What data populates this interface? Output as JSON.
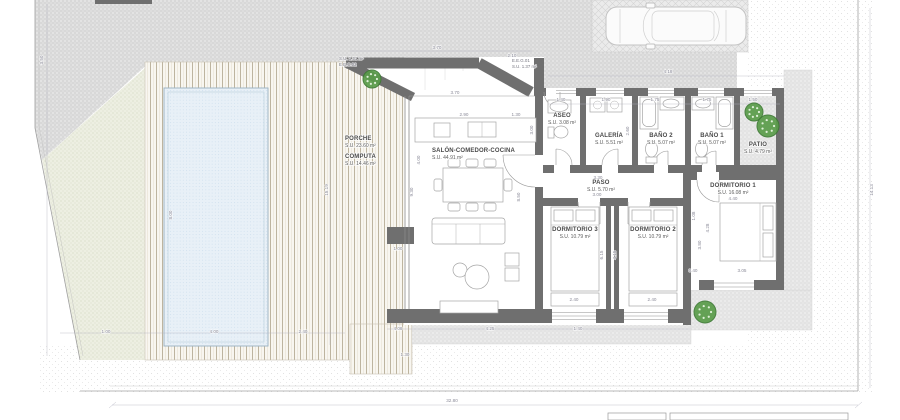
{
  "drawing": {
    "type": "architectural-floor-plan",
    "overall_width_label": "32.80"
  },
  "colors": {
    "walls": "#6f6f6f",
    "ground_hatch": "#d8d8d8",
    "lawn": "#edefe2",
    "deck_line": "#bdb49f",
    "pool_water": "#e8f0f7",
    "tree": "#5a9c4a",
    "dim_text": "#8a8a98",
    "label_text": "#4a4a4a"
  },
  "rooms": [
    {
      "id": "porche",
      "name": "PORCHE",
      "area": "S.U. 23.60 m²",
      "x": 345,
      "y": 140,
      "align": "start"
    },
    {
      "id": "computa",
      "name": "COMPUTA",
      "area": "S.U. 14.46 m²",
      "x": 345,
      "y": 158,
      "align": "start"
    },
    {
      "id": "salon",
      "name": "SALÓN-COMEDOR-COCINA",
      "area": "S.U. 44.91 m²",
      "x": 432,
      "y": 152,
      "align": "start"
    },
    {
      "id": "aseo",
      "name": "ASEO",
      "area": "S.U. 3.08 m²",
      "x": 562,
      "y": 117,
      "align": "middle"
    },
    {
      "id": "galeria",
      "name": "GALERÍA",
      "area": "S.U. 5.51 m²",
      "x": 609,
      "y": 137,
      "align": "middle"
    },
    {
      "id": "bano2",
      "name": "BAÑO 2",
      "area": "S.U. 5.07 m²",
      "x": 661,
      "y": 137,
      "align": "middle"
    },
    {
      "id": "bano1",
      "name": "BAÑO 1",
      "area": "S.U. 5.07 m²",
      "x": 712,
      "y": 137,
      "align": "middle"
    },
    {
      "id": "patio",
      "name": "PATIO",
      "area": "S.U. 4.79 m²",
      "x": 758,
      "y": 146,
      "align": "middle"
    },
    {
      "id": "paso",
      "name": "PASO",
      "area": "S.U. 5.70 m²",
      "x": 601,
      "y": 184,
      "align": "middle"
    },
    {
      "id": "dormitorio1",
      "name": "DORMITORIO 1",
      "area": "S.U. 16.08 m²",
      "x": 733,
      "y": 187,
      "align": "middle"
    },
    {
      "id": "dormitorio3",
      "name": "DORMITORIO 3",
      "area": "S.U. 10.79 m²",
      "x": 575,
      "y": 231,
      "align": "middle"
    },
    {
      "id": "dormitorio2",
      "name": "DORMITORIO 2",
      "area": "S.U. 10.79 m²",
      "x": 653,
      "y": 231,
      "align": "middle"
    }
  ],
  "annotations": {
    "a0": {
      "line1": "S.U. 1.31 m²",
      "line2": "E.E.C.02"
    },
    "a1": {
      "line1": "E.E.G.01",
      "line2": "S.U. 1.37 m²"
    }
  },
  "dimensions": [
    {
      "t": "3.70",
      "x": 437,
      "y": 49
    },
    {
      "t": "2.10",
      "x": 512,
      "y": 57
    },
    {
      "t": "4.18",
      "x": 668,
      "y": 73
    },
    {
      "t": "3.70",
      "x": 455,
      "y": 94
    },
    {
      "t": "2.90",
      "x": 464,
      "y": 116
    },
    {
      "t": "1.30",
      "x": 516,
      "y": 116
    },
    {
      "t": "1.40",
      "x": 561,
      "y": 101
    },
    {
      "t": "1.90",
      "x": 606,
      "y": 101
    },
    {
      "t": "1.75",
      "x": 655,
      "y": 101
    },
    {
      "t": "1.75",
      "x": 707,
      "y": 101
    },
    {
      "t": "1.50",
      "x": 753,
      "y": 101
    },
    {
      "t": "3.00",
      "x": 533,
      "y": 130,
      "rot": -90
    },
    {
      "t": "2.60",
      "x": 629,
      "y": 131,
      "rot": -90
    },
    {
      "t": "3.30",
      "x": 598,
      "y": 179
    },
    {
      "t": "3.00",
      "x": 597,
      "y": 196
    },
    {
      "t": "4.40",
      "x": 733,
      "y": 200
    },
    {
      "t": "1.08",
      "x": 695,
      "y": 216,
      "rot": -90
    },
    {
      "t": "6.15",
      "x": 603,
      "y": 255,
      "rot": -90
    },
    {
      "t": "4.15",
      "x": 616,
      "y": 255,
      "rot": -90
    },
    {
      "t": "4.28",
      "x": 709,
      "y": 228,
      "rot": -90
    },
    {
      "t": "3.80",
      "x": 701,
      "y": 245,
      "rot": -90
    },
    {
      "t": "2.40",
      "x": 574,
      "y": 301
    },
    {
      "t": "2.40",
      "x": 652,
      "y": 301
    },
    {
      "t": "0.40",
      "x": 693,
      "y": 272
    },
    {
      "t": "3.05",
      "x": 742,
      "y": 272
    },
    {
      "t": "9.30",
      "x": 413,
      "y": 192,
      "rot": -90
    },
    {
      "t": "4.00",
      "x": 420,
      "y": 160,
      "rot": -90
    },
    {
      "t": "8.50",
      "x": 520,
      "y": 197,
      "rot": -90
    },
    {
      "t": "1.00",
      "x": 398,
      "y": 250
    },
    {
      "t": "1.00",
      "x": 106,
      "y": 333
    },
    {
      "t": "4.00",
      "x": 214,
      "y": 333
    },
    {
      "t": "2.40",
      "x": 303,
      "y": 333
    },
    {
      "t": "8.00",
      "x": 172,
      "y": 215,
      "rot": -90
    },
    {
      "t": "15.19",
      "x": 328,
      "y": 190,
      "rot": -90
    },
    {
      "t": "4.08",
      "x": 398,
      "y": 330
    },
    {
      "t": "4.25",
      "x": 490,
      "y": 330
    },
    {
      "t": "1.40",
      "x": 578,
      "y": 330
    },
    {
      "t": "1.30",
      "x": 405,
      "y": 356
    },
    {
      "t": "3.50",
      "x": 43,
      "y": 60,
      "rot": -90
    },
    {
      "t": "14.13",
      "x": 873,
      "y": 190,
      "rot": -90
    },
    {
      "t": "32.80",
      "x": 452,
      "y": 402
    }
  ],
  "site": {
    "trees": [
      {
        "x": 372,
        "y": 79,
        "r": 9
      },
      {
        "x": 754,
        "y": 112,
        "r": 9
      },
      {
        "x": 768,
        "y": 126,
        "r": 11
      },
      {
        "x": 705,
        "y": 312,
        "r": 11
      }
    ]
  }
}
